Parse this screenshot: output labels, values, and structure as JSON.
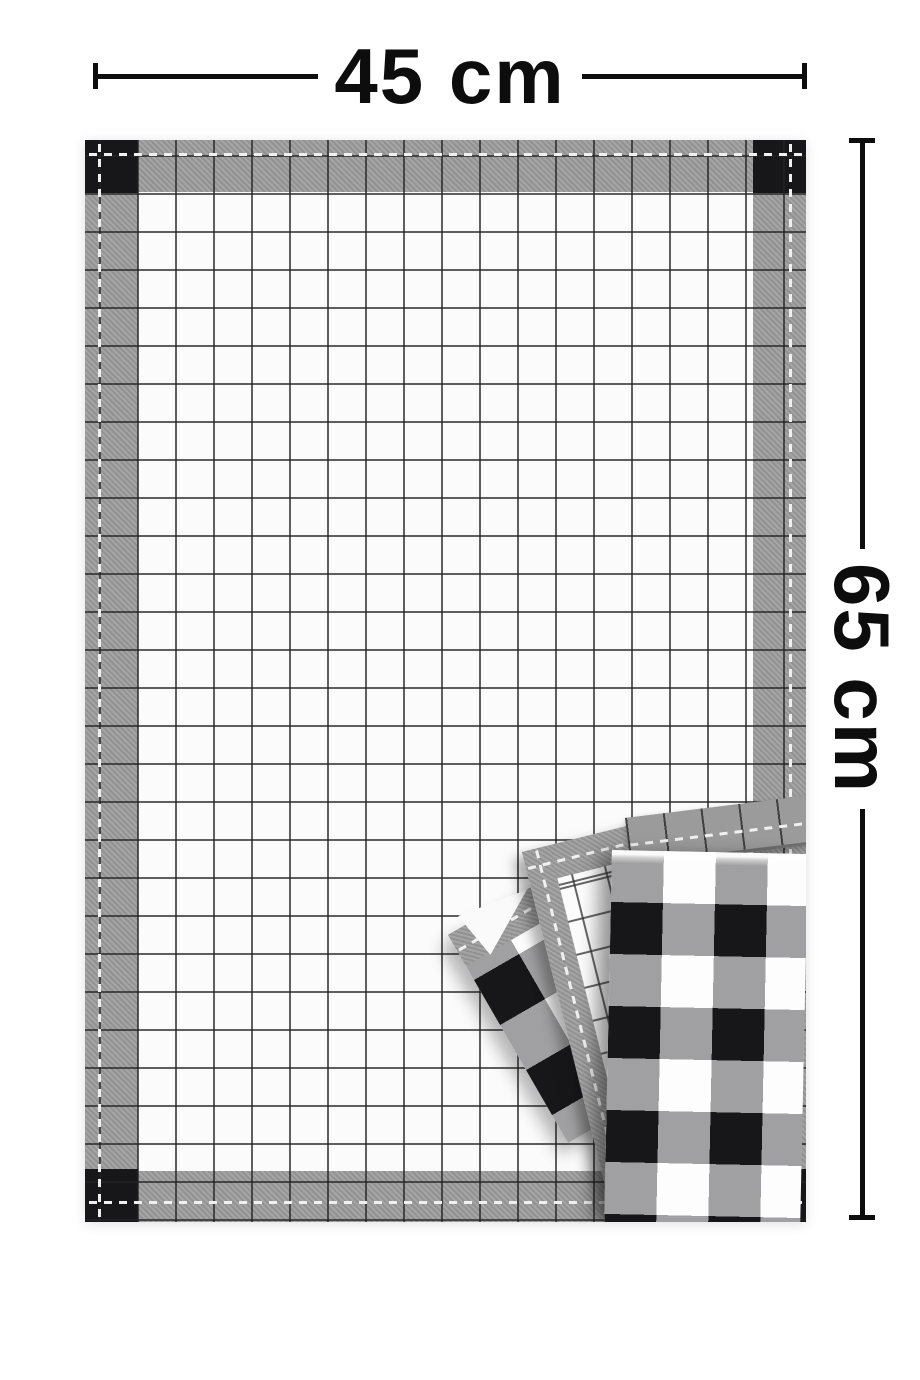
{
  "annotations": {
    "width_label": "45 cm",
    "height_label": "65 cm"
  },
  "product": {
    "main_towel_pattern": "windowpane-check",
    "main_towel_border": "heather-gray band with black corner squares and white hem stitching",
    "folded_towels_pattern": "buffalo-check",
    "folded_towels_count": 3
  },
  "colors": {
    "background": "#ffffff",
    "fabric_white": "#fbfbfb",
    "heather_gray": "#9b9b9b",
    "check_black": "#17171a",
    "grid_line": "#2e2e2e",
    "stitch_white": "#f0f0f0",
    "dimension_ink": "#0d0d0d"
  }
}
